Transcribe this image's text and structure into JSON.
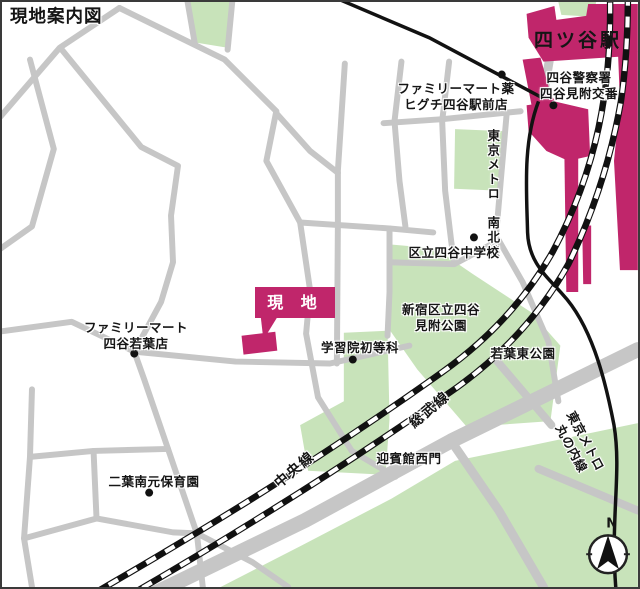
{
  "title": "現地案内図",
  "colors": {
    "site_magenta": "#c0266b",
    "park_green": "#c8e3ba",
    "road_gray": "#c6c6c6",
    "ink": "#151515"
  },
  "station": {
    "name": "四ツ谷駅"
  },
  "site": {
    "label": "現 地"
  },
  "pois": {
    "police": {
      "line1": "四谷警察署",
      "line2": "四谷見附交番"
    },
    "familymart_higuchi": {
      "line1": "ファミリーマート薬",
      "line2": "ヒグチ四谷駅前店"
    },
    "junior_high": {
      "text": "区立四谷中学校"
    },
    "mitsuke_park": {
      "line1": "新宿区立四谷",
      "line2": "見附公園"
    },
    "wakaba_park": {
      "text": "若葉東公園"
    },
    "gakushuin": {
      "text": "学習院初等科"
    },
    "familymart_wakaba": {
      "line1": "ファミリーマート",
      "line2": "四谷若葉店"
    },
    "geihinkan": {
      "text": "迎賓館西門"
    },
    "futaba_nursery": {
      "text": "二葉南元保育園"
    }
  },
  "rail": {
    "chuo": "中央線",
    "sobu": "総武線",
    "namboku_line1": "東京メトロ",
    "namboku_line2": "南北線",
    "marunouchi_line1": "東京メトロ",
    "marunouchi_line2": "丸の内線"
  },
  "compass": {
    "north": "N"
  }
}
